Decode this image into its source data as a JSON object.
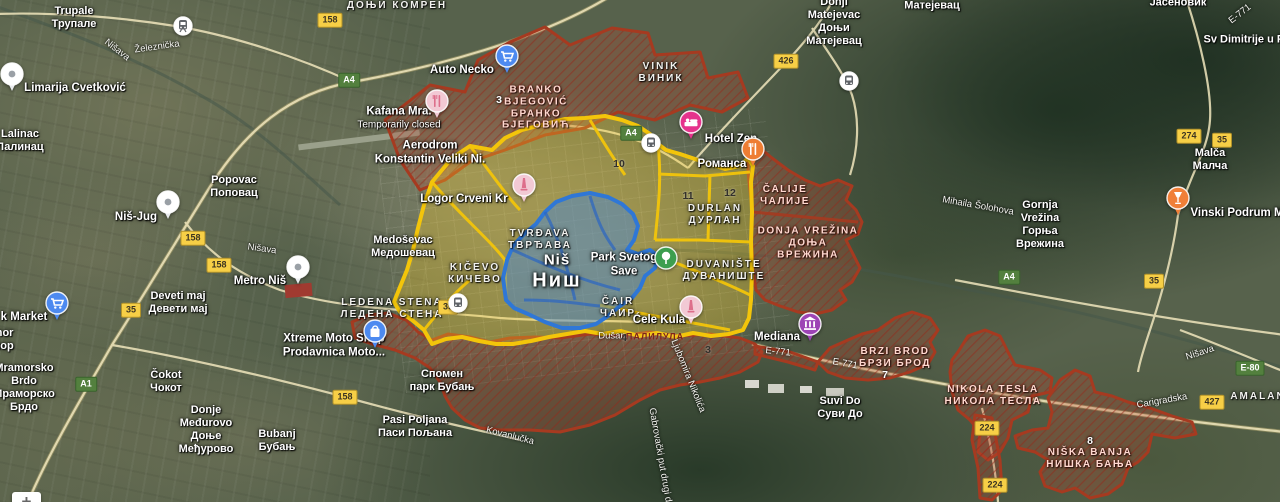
{
  "map": {
    "overlay_colors": {
      "yellow": "#f3c50a",
      "blue": "#2f77d6",
      "red": "#a63a20"
    },
    "zoom_control": {
      "plus_label": "+"
    },
    "labels": [
      {
        "id": "trupale",
        "kind": "town",
        "x": 74,
        "y": 18,
        "lines": [
          "Trupale",
          "Трупале"
        ]
      },
      {
        "id": "lalinac",
        "kind": "town",
        "x": 20,
        "y": 141,
        "lines": [
          "Lalinac",
          "Лалинац"
        ]
      },
      {
        "id": "donji-komren",
        "kind": "district",
        "x": 397,
        "y": 6,
        "lines": [
          "ДОЊИ КОМРЕН"
        ]
      },
      {
        "id": "donji-matejevac",
        "kind": "town",
        "x": 834,
        "y": 22,
        "lines": [
          "Donji",
          "Matejevac",
          "Доњи",
          "Матејевац"
        ]
      },
      {
        "id": "matejevac",
        "kind": "town",
        "x": 932,
        "y": 6,
        "lines": [
          "Матејевац"
        ]
      },
      {
        "id": "jasenovik",
        "kind": "town",
        "x": 1178,
        "y": 3,
        "lines": [
          "Јасеновик"
        ]
      },
      {
        "id": "sv-dimitrije",
        "kind": "town",
        "x": 1250,
        "y": 40,
        "lines": [
          "Sv  Dimitrije u Pas"
        ]
      },
      {
        "id": "vinik",
        "kind": "district",
        "x": 661,
        "y": 73,
        "lines": [
          "VINIK",
          "ВИНИК"
        ]
      },
      {
        "id": "malca",
        "kind": "town",
        "x": 1210,
        "y": 160,
        "lines": [
          "Malča",
          "Малча"
        ]
      },
      {
        "id": "popovac",
        "kind": "town",
        "x": 234,
        "y": 187,
        "lines": [
          "Popovac",
          "Поповац"
        ]
      },
      {
        "id": "gornja-vrezina",
        "kind": "town",
        "x": 1040,
        "y": 225,
        "lines": [
          "Gornja",
          "Vrežina",
          "Горња",
          "Врежина"
        ]
      },
      {
        "id": "deveti-maj",
        "kind": "town",
        "x": 178,
        "y": 303,
        "lines": [
          "Deveti maj",
          "Девети мај"
        ]
      },
      {
        "id": "medosevac",
        "kind": "town",
        "x": 403,
        "y": 247,
        "lines": [
          "Medoševac",
          "Медошевац"
        ]
      },
      {
        "id": "cokot",
        "kind": "town",
        "x": 166,
        "y": 382,
        "lines": [
          "Čokot",
          "Чокот"
        ]
      },
      {
        "id": "donje-medjurovo",
        "kind": "town",
        "x": 206,
        "y": 430,
        "lines": [
          "Donje",
          "Međurovo",
          "Доње",
          "Међурово"
        ]
      },
      {
        "id": "bubanj",
        "kind": "town",
        "x": 277,
        "y": 441,
        "lines": [
          "Bubanj",
          "Бубањ"
        ]
      },
      {
        "id": "pasi-poljana",
        "kind": "town",
        "x": 415,
        "y": 427,
        "lines": [
          "Pasi Poljana",
          "Паси Пољана"
        ]
      },
      {
        "id": "suvi-do",
        "kind": "town",
        "x": 840,
        "y": 408,
        "lines": [
          "Suvi Do",
          "Суви До"
        ]
      },
      {
        "id": "mramorsko-brdo",
        "kind": "town",
        "x": 24,
        "y": 388,
        "lines": [
          "Mramorsko",
          "Brdo",
          "Мраморско",
          "Брдо"
        ]
      },
      {
        "id": "mramor",
        "kind": "town",
        "x": 0,
        "y": 340,
        "lines": [
          "amor",
          "емор"
        ]
      },
      {
        "id": "spomen-park-bubanj",
        "kind": "town",
        "x": 442,
        "y": 381,
        "lines": [
          "Спомен",
          "парк Бубањ"
        ]
      },
      {
        "id": "amalan",
        "kind": "district",
        "x": 1258,
        "y": 397,
        "lines": [
          "AMALAN"
        ]
      },
      {
        "id": "kicevo",
        "kind": "district",
        "x": 475,
        "y": 274,
        "lines": [
          "KIČEVO",
          "КИЧЕВО"
        ]
      },
      {
        "id": "cair",
        "kind": "district",
        "x": 618,
        "y": 308,
        "lines": [
          "ČAIR",
          "ЧАИР"
        ]
      },
      {
        "id": "durlan",
        "kind": "district",
        "x": 715,
        "y": 215,
        "lines": [
          "DURLAN",
          "ДУРЛАН"
        ]
      },
      {
        "id": "duvaniste",
        "kind": "district",
        "x": 724,
        "y": 271,
        "lines": [
          "DUVANIŠTE",
          "ДУВАНИШТЕ"
        ]
      },
      {
        "id": "ledena-stena",
        "kind": "district",
        "x": 392,
        "y": 309,
        "lines": [
          "LEDENA STENA",
          "ЛЕДЕНА СТЕНА"
        ]
      },
      {
        "id": "tvrdjava",
        "kind": "district",
        "x": 540,
        "y": 240,
        "lines": [
          "TVRĐAVA",
          "ТВРЂАВА"
        ]
      },
      {
        "id": "nis-city",
        "kind": "city",
        "x": 557,
        "y": 272,
        "lines": [
          "Niš",
          "Ниш"
        ]
      },
      {
        "id": "branko-bjegovic",
        "kind": "region",
        "x": 536,
        "y": 108,
        "lines": [
          "BRANKO",
          "BJEGOVIĆ",
          "БРАНКО",
          "БЈЕГОВИЋ"
        ]
      },
      {
        "id": "calije",
        "kind": "region",
        "x": 785,
        "y": 196,
        "lines": [
          "ČALIJE",
          "ЧАЛИЈЕ"
        ]
      },
      {
        "id": "donja-vrezina",
        "kind": "region",
        "x": 808,
        "y": 243,
        "lines": [
          "DONJA VREŽINA",
          "ДОЊА",
          "ВРЕЖИНА"
        ]
      },
      {
        "id": "brzi-brod",
        "kind": "region",
        "x": 895,
        "y": 358,
        "lines": [
          "BRZI BROD",
          "БРЗИ БРОД"
        ]
      },
      {
        "id": "nikola-tesla",
        "kind": "region",
        "x": 993,
        "y": 396,
        "lines": [
          "NIKOLA TESLA",
          "НИКОЛА ТЕСЛА"
        ]
      },
      {
        "id": "niska-banja",
        "kind": "region",
        "x": 1090,
        "y": 459,
        "lines": [
          "NIŠKA BANJA",
          "НИШКА БАЊА"
        ]
      },
      {
        "id": "palilula",
        "kind": "region-sub",
        "x": 655,
        "y": 337,
        "lines": [
          "ПАЛИЛУЛА"
        ]
      },
      {
        "id": "auto-necko",
        "kind": "poi",
        "x": 462,
        "y": 71,
        "lines": [
          "Auto Necko"
        ]
      },
      {
        "id": "kafana-mra",
        "kind": "poi2",
        "x": 399,
        "y": 118,
        "lines": [
          "Kafana Mra.",
          "Temporarily closed"
        ]
      },
      {
        "id": "aerodrom",
        "kind": "poi",
        "x": 430,
        "y": 153,
        "lines": [
          "Aerodrom",
          "Konstantin Veliki Ni."
        ]
      },
      {
        "id": "hotel-zen",
        "kind": "poi",
        "x": 731,
        "y": 140,
        "lines": [
          "Hotel Zen"
        ]
      },
      {
        "id": "romansa",
        "kind": "poi",
        "x": 722,
        "y": 165,
        "lines": [
          "Романса"
        ]
      },
      {
        "id": "logor-crveni-krst",
        "kind": "poi",
        "x": 464,
        "y": 200,
        "lines": [
          "Logor Crveni Kr"
        ]
      },
      {
        "id": "nis-jug",
        "kind": "poi",
        "x": 136,
        "y": 218,
        "lines": [
          "Niš-Jug"
        ]
      },
      {
        "id": "metro-nis",
        "kind": "poi",
        "x": 260,
        "y": 282,
        "lines": [
          "Metro Niš"
        ]
      },
      {
        "id": "limarija-cvetkovic",
        "kind": "poi",
        "x": 75,
        "y": 89,
        "lines": [
          "Limarija Cvetković"
        ]
      },
      {
        "id": "k-market",
        "kind": "poi",
        "x": 24,
        "y": 318,
        "lines": [
          "k Market"
        ]
      },
      {
        "id": "xtreme-moto",
        "kind": "poi",
        "x": 334,
        "y": 346,
        "lines": [
          "Xtreme Moto Shop",
          "Prodavnica Moto..."
        ]
      },
      {
        "id": "cele-kula",
        "kind": "poi",
        "x": 659,
        "y": 321,
        "lines": [
          "Ćele Kula"
        ]
      },
      {
        "id": "mediana",
        "kind": "poi",
        "x": 777,
        "y": 338,
        "lines": [
          "Mediana"
        ]
      },
      {
        "id": "vinski-podrum",
        "kind": "poi",
        "x": 1237,
        "y": 214,
        "lines": [
          "Vinski Podrum M"
        ]
      },
      {
        "id": "park-svetog-save",
        "kind": "poi",
        "x": 624,
        "y": 265,
        "lines": [
          "Park Svetog",
          "Save"
        ]
      },
      {
        "id": "dusan",
        "kind": "street",
        "x": 612,
        "y": 336,
        "lines": [
          "Dušan"
        ]
      },
      {
        "id": "zeleznicka",
        "kind": "street",
        "x": 157,
        "y": 47,
        "rot": -8,
        "lines": [
          "Železnička"
        ]
      },
      {
        "id": "nisava-1",
        "kind": "street",
        "x": 117,
        "y": 50,
        "rot": 38,
        "lines": [
          "Nišava"
        ]
      },
      {
        "id": "nisava-2",
        "kind": "street",
        "x": 262,
        "y": 249,
        "rot": 8,
        "lines": [
          "Nišava"
        ]
      },
      {
        "id": "nisava-3",
        "kind": "street",
        "x": 1200,
        "y": 353,
        "rot": -18,
        "lines": [
          "Nišava"
        ]
      },
      {
        "id": "mihaila-solohova",
        "kind": "street",
        "x": 978,
        "y": 206,
        "rot": 10,
        "lines": [
          "Mihaila Šolohova"
        ]
      },
      {
        "id": "carigradska",
        "kind": "street",
        "x": 1162,
        "y": 401,
        "rot": -10,
        "lines": [
          "Carigradska"
        ]
      },
      {
        "id": "kovanlucka",
        "kind": "street",
        "x": 510,
        "y": 436,
        "rot": 14,
        "lines": [
          "Kovanlučka"
        ]
      },
      {
        "id": "ljubomira-nikolica",
        "kind": "street",
        "x": 688,
        "y": 376,
        "rot": 68,
        "lines": [
          "Ljubomira Nikolića"
        ]
      },
      {
        "id": "gabrovacki-put",
        "kind": "street",
        "x": 660,
        "y": 455,
        "rot": 80,
        "lines": [
          "Gabrovački put drugi d"
        ]
      },
      {
        "id": "e771-1",
        "kind": "street",
        "x": 778,
        "y": 352,
        "rot": 6,
        "lines": [
          "E-771"
        ]
      },
      {
        "id": "e771-2",
        "kind": "street",
        "x": 845,
        "y": 364,
        "rot": 10,
        "lines": [
          "E-771"
        ]
      },
      {
        "id": "e771-3",
        "kind": "street",
        "x": 1240,
        "y": 14,
        "rot": -38,
        "lines": [
          "E-771"
        ]
      }
    ],
    "numbers": [
      {
        "t": "3",
        "x": 499,
        "y": 100,
        "light": true
      },
      {
        "t": "10",
        "x": 619,
        "y": 164,
        "light": false
      },
      {
        "t": "11",
        "x": 688,
        "y": 196,
        "light": false
      },
      {
        "t": "12",
        "x": 730,
        "y": 193,
        "light": false
      },
      {
        "t": "4",
        "x": 624,
        "y": 338,
        "light": false
      },
      {
        "t": "3",
        "x": 708,
        "y": 350,
        "light": false
      },
      {
        "t": "5",
        "x": 687,
        "y": 313,
        "light": false
      },
      {
        "t": "7",
        "x": 885,
        "y": 375,
        "light": true
      },
      {
        "t": "8",
        "x": 1090,
        "y": 441,
        "light": true
      }
    ],
    "shields": [
      {
        "t": "158",
        "kind": "y",
        "x": 330,
        "y": 20
      },
      {
        "t": "158",
        "kind": "y",
        "x": 193,
        "y": 238
      },
      {
        "t": "158",
        "kind": "y",
        "x": 219,
        "y": 265
      },
      {
        "t": "158",
        "kind": "y",
        "x": 345,
        "y": 397
      },
      {
        "t": "35",
        "kind": "y",
        "x": 131,
        "y": 310
      },
      {
        "t": "35",
        "kind": "y",
        "x": 448,
        "y": 307
      },
      {
        "t": "35",
        "kind": "y",
        "x": 1154,
        "y": 281
      },
      {
        "t": "35",
        "kind": "y",
        "x": 1222,
        "y": 140
      },
      {
        "t": "426",
        "kind": "y",
        "x": 786,
        "y": 61
      },
      {
        "t": "274",
        "kind": "y",
        "x": 1189,
        "y": 136
      },
      {
        "t": "427",
        "kind": "y",
        "x": 1212,
        "y": 402
      },
      {
        "t": "224",
        "kind": "y",
        "x": 987,
        "y": 428
      },
      {
        "t": "224",
        "kind": "y",
        "x": 995,
        "y": 485
      },
      {
        "t": "A4",
        "kind": "g",
        "x": 349,
        "y": 80
      },
      {
        "t": "A4",
        "kind": "g",
        "x": 631,
        "y": 133
      },
      {
        "t": "A4",
        "kind": "g",
        "x": 1009,
        "y": 277
      },
      {
        "t": "A1",
        "kind": "g",
        "x": 86,
        "y": 384
      },
      {
        "t": "E-80",
        "kind": "g",
        "x": 1250,
        "y": 368
      }
    ],
    "pois": [
      {
        "id": "limarija-pin",
        "type": "pin",
        "x": 12,
        "y": 88,
        "bg": "#ffffff"
      },
      {
        "id": "nis-jug-pin",
        "type": "pin",
        "x": 168,
        "y": 216,
        "bg": "#ffffff"
      },
      {
        "id": "metro-nis-pin",
        "type": "pin",
        "x": 298,
        "y": 281,
        "bg": "#ffffff"
      },
      {
        "id": "zeleznicka-station",
        "type": "train-station",
        "x": 183,
        "y": 29,
        "bg": "#ffffff"
      },
      {
        "id": "auto-necko-cart",
        "type": "shopping-cart",
        "x": 507,
        "y": 70,
        "bg": "#4d8af0",
        "pin": true
      },
      {
        "id": "k-market-cart",
        "type": "shopping-cart",
        "x": 57,
        "y": 317,
        "bg": "#4d8af0",
        "pin": true
      },
      {
        "id": "kafana-restaurant",
        "type": "restaurant",
        "x": 437,
        "y": 115,
        "bg": "#f2c9d4",
        "fg": "#dd6e8b",
        "pin": true
      },
      {
        "id": "hotel-zen-bed",
        "type": "bed",
        "x": 691,
        "y": 136,
        "bg": "#e5338c",
        "pin": true
      },
      {
        "id": "romansa-restaurant",
        "type": "restaurant",
        "x": 753,
        "y": 163,
        "bg": "#ee7d33",
        "pin": true
      },
      {
        "id": "logor-monument",
        "type": "monument",
        "x": 524,
        "y": 199,
        "bg": "#f2c9d4",
        "fg": "#dd6e8b",
        "pin": true
      },
      {
        "id": "cele-kula-monument",
        "type": "monument",
        "x": 691,
        "y": 321,
        "bg": "#f2c9d4",
        "fg": "#dd6e8b",
        "pin": true
      },
      {
        "id": "mediana-museum",
        "type": "museum",
        "x": 810,
        "y": 338,
        "bg": "#9d44b5",
        "pin": true
      },
      {
        "id": "vinski-wine",
        "type": "wine",
        "x": 1178,
        "y": 212,
        "bg": "#f07f38",
        "pin": true
      },
      {
        "id": "park-tree",
        "type": "tree",
        "x": 666,
        "y": 261,
        "bg": "#3d9e4f"
      },
      {
        "id": "xtreme-bag",
        "type": "bag",
        "x": 375,
        "y": 345,
        "bg": "#4d8af0",
        "pin": true
      },
      {
        "id": "transit-1",
        "type": "transit",
        "x": 651,
        "y": 146,
        "bg": "#ffffff"
      },
      {
        "id": "transit-2",
        "type": "transit",
        "x": 849,
        "y": 84,
        "bg": "#ffffff"
      },
      {
        "id": "transit-3",
        "type": "transit",
        "x": 458,
        "y": 306,
        "bg": "#ffffff"
      }
    ]
  }
}
